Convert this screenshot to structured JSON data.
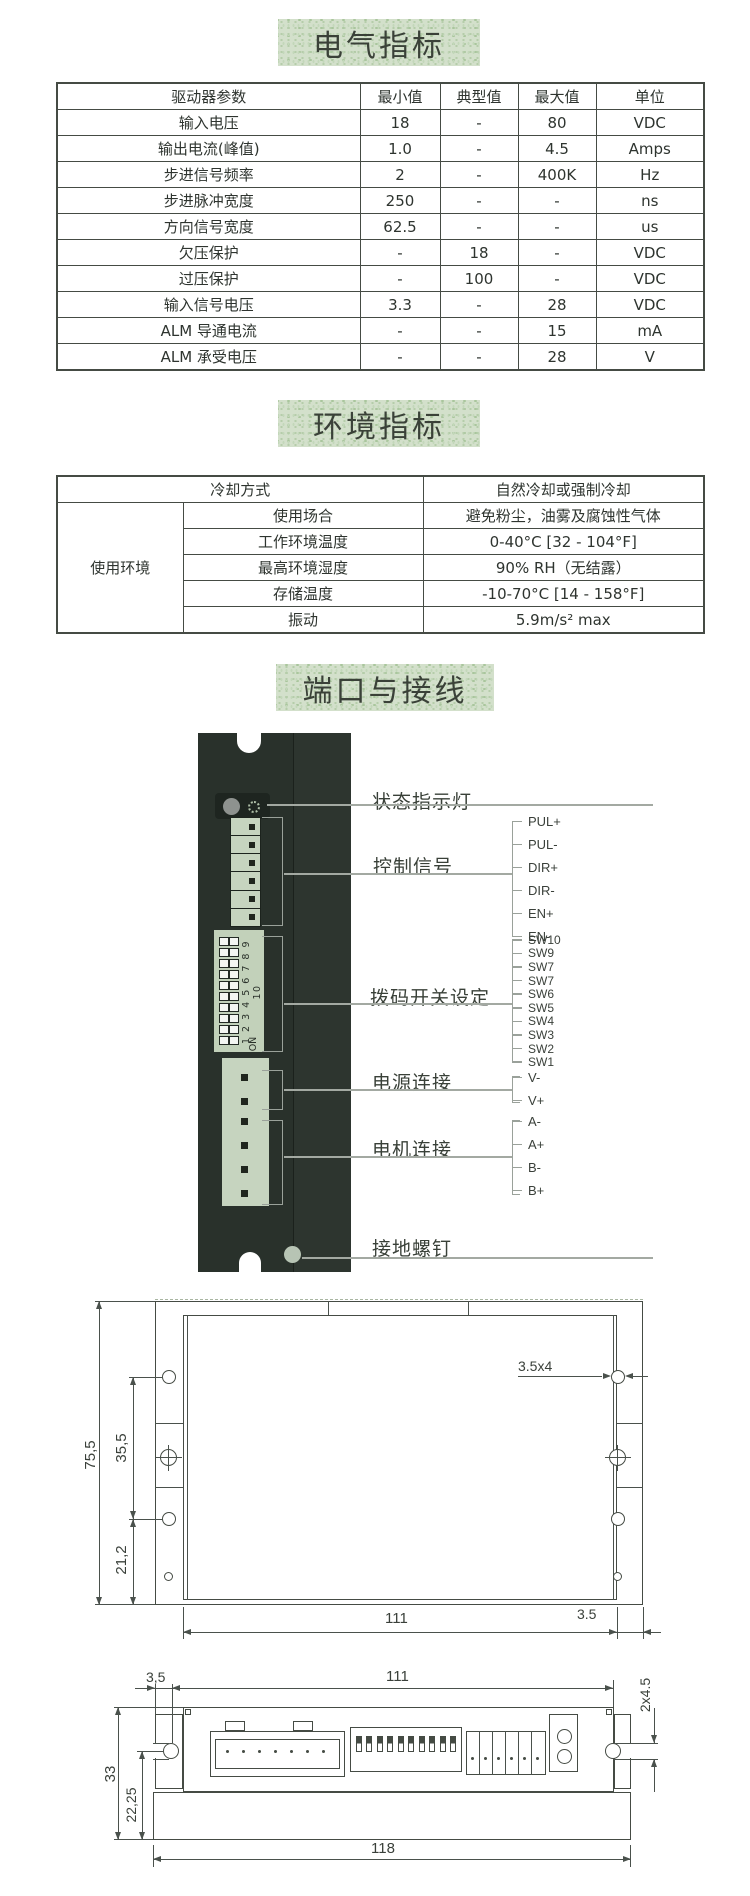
{
  "sections": {
    "electrical": {
      "title": "电气指标",
      "table": {
        "headers": [
          "驱动器参数",
          "最小值",
          "典型值",
          "最大值",
          "单位"
        ],
        "rows": [
          [
            "输入电压",
            "18",
            "-",
            "80",
            "VDC"
          ],
          [
            "输出电流(峰值)",
            "1.0",
            "-",
            "4.5",
            "Amps"
          ],
          [
            "步进信号频率",
            "2",
            "-",
            "400K",
            "Hz"
          ],
          [
            "步进脉冲宽度",
            "250",
            "-",
            "-",
            "ns"
          ],
          [
            "方向信号宽度",
            "62.5",
            "-",
            "-",
            "us"
          ],
          [
            "欠压保护",
            "-",
            "18",
            "-",
            "VDC"
          ],
          [
            "过压保护",
            "-",
            "100",
            "-",
            "VDC"
          ],
          [
            "输入信号电压",
            "3.3",
            "-",
            "28",
            "VDC"
          ],
          [
            "ALM 导通电流",
            "-",
            "-",
            "15",
            "mA"
          ],
          [
            "ALM 承受电压",
            "-",
            "-",
            "28",
            "V"
          ]
        ]
      }
    },
    "environment": {
      "title": "环境指标",
      "table": {
        "cooling_label": "冷却方式",
        "cooling_value": "自然冷却或强制冷却",
        "group_label": "使用环境",
        "rows": [
          {
            "label": "使用场合",
            "value": "避免粉尘，油雾及腐蚀性气体"
          },
          {
            "label": "工作环境温度",
            "value": "0-40°C [32 - 104°F]"
          },
          {
            "label": "最高环境湿度",
            "value": "90% RH（无结露）"
          },
          {
            "label": "存储温度",
            "value": "-10-70°C [14 - 158°F]"
          },
          {
            "label": "振动",
            "value": "5.9m/s² max"
          }
        ]
      }
    },
    "ports": {
      "title": "端口与接线",
      "labels": {
        "status_led": "状态指示灯",
        "control_signal": "控制信号",
        "dip_switch": "拨码开关设定",
        "power": "电源连接",
        "motor": "电机连接",
        "ground_screw": "接地螺钉"
      },
      "control_pins": [
        "PUL+",
        "PUL-",
        "DIR+",
        "DIR-",
        "EN+",
        "EN-"
      ],
      "sw_pins": [
        "SW10",
        "SW9",
        "SW7",
        "SW7",
        "SW6",
        "SW5",
        "SW4",
        "SW3",
        "SW2",
        "SW1"
      ],
      "power_pins": [
        "V-",
        "V+"
      ],
      "motor_pins": [
        "A-",
        "A+",
        "B-",
        "B+"
      ],
      "dip_numbers": "1 2 3 4 5 6 7 8 9 10",
      "dip_on": "ON"
    },
    "mechanical": {
      "top_view": {
        "height_overall": "75,5",
        "hole_span": "35,5",
        "hole_bottom": "21,2",
        "hole_size": "3.5x4",
        "width_body": "111",
        "flange_offset": "3.5"
      },
      "side_view": {
        "offset_left": "3,5",
        "width_body": "111",
        "slot_size": "2x4.5",
        "height_overall": "33",
        "height_slot": "22,25",
        "width_overall": "118"
      }
    }
  },
  "colors": {
    "title_band_green": "#d3e0cb",
    "device_body": "#29312b",
    "connector_green": "#c6d4bf",
    "led_gray": "#8e928f",
    "drawing_line": "#454b44"
  }
}
